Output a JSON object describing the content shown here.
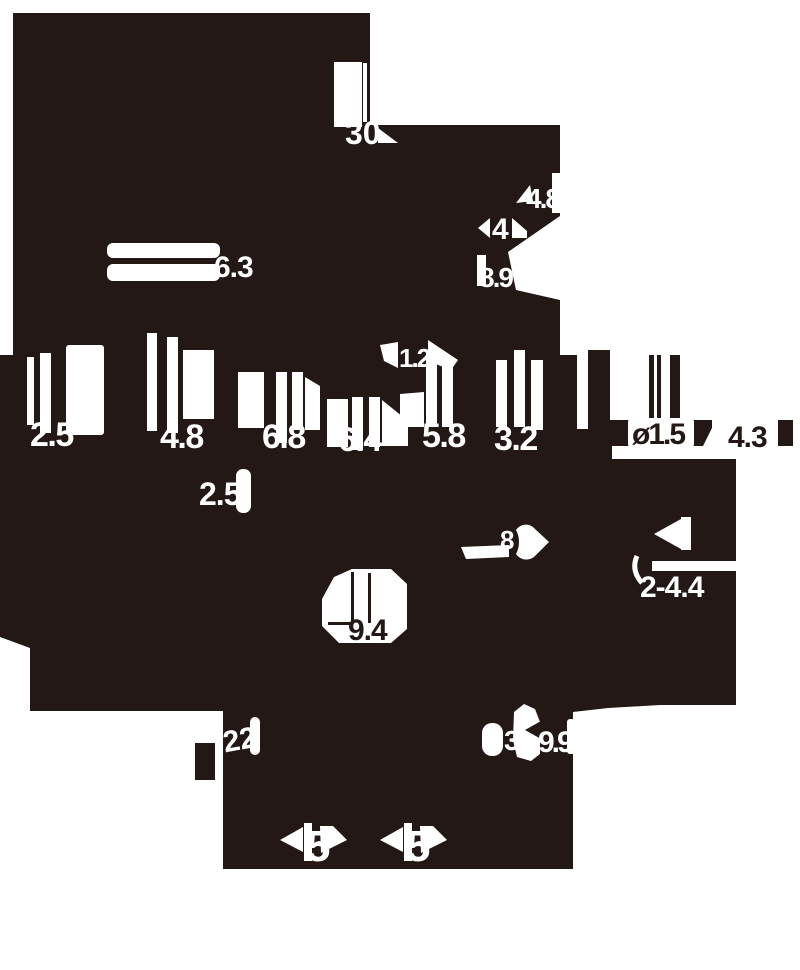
{
  "drawing_type": "technical-dimension-drawing",
  "colors": {
    "ink": "#231815",
    "paper": "#ffffff"
  },
  "dimensions": {
    "d30": "30",
    "d63": "6.3",
    "d48_top": "4.8",
    "d4": "4",
    "d89": "8.9",
    "d12": "1.2",
    "d25": "2.5",
    "d48": "4.8",
    "d68": "6.8",
    "d64": "6.4",
    "d58": "5.8",
    "d32": "3.2",
    "dia15": "ø1.5",
    "d43": "4.3",
    "d25_mid": "2.5",
    "d8": "8",
    "d2x44": "2-4.4",
    "d94": "9.4",
    "d22": "22",
    "d3": "3",
    "d99": "9.9",
    "d5_left": "5",
    "d5_right": "5"
  }
}
